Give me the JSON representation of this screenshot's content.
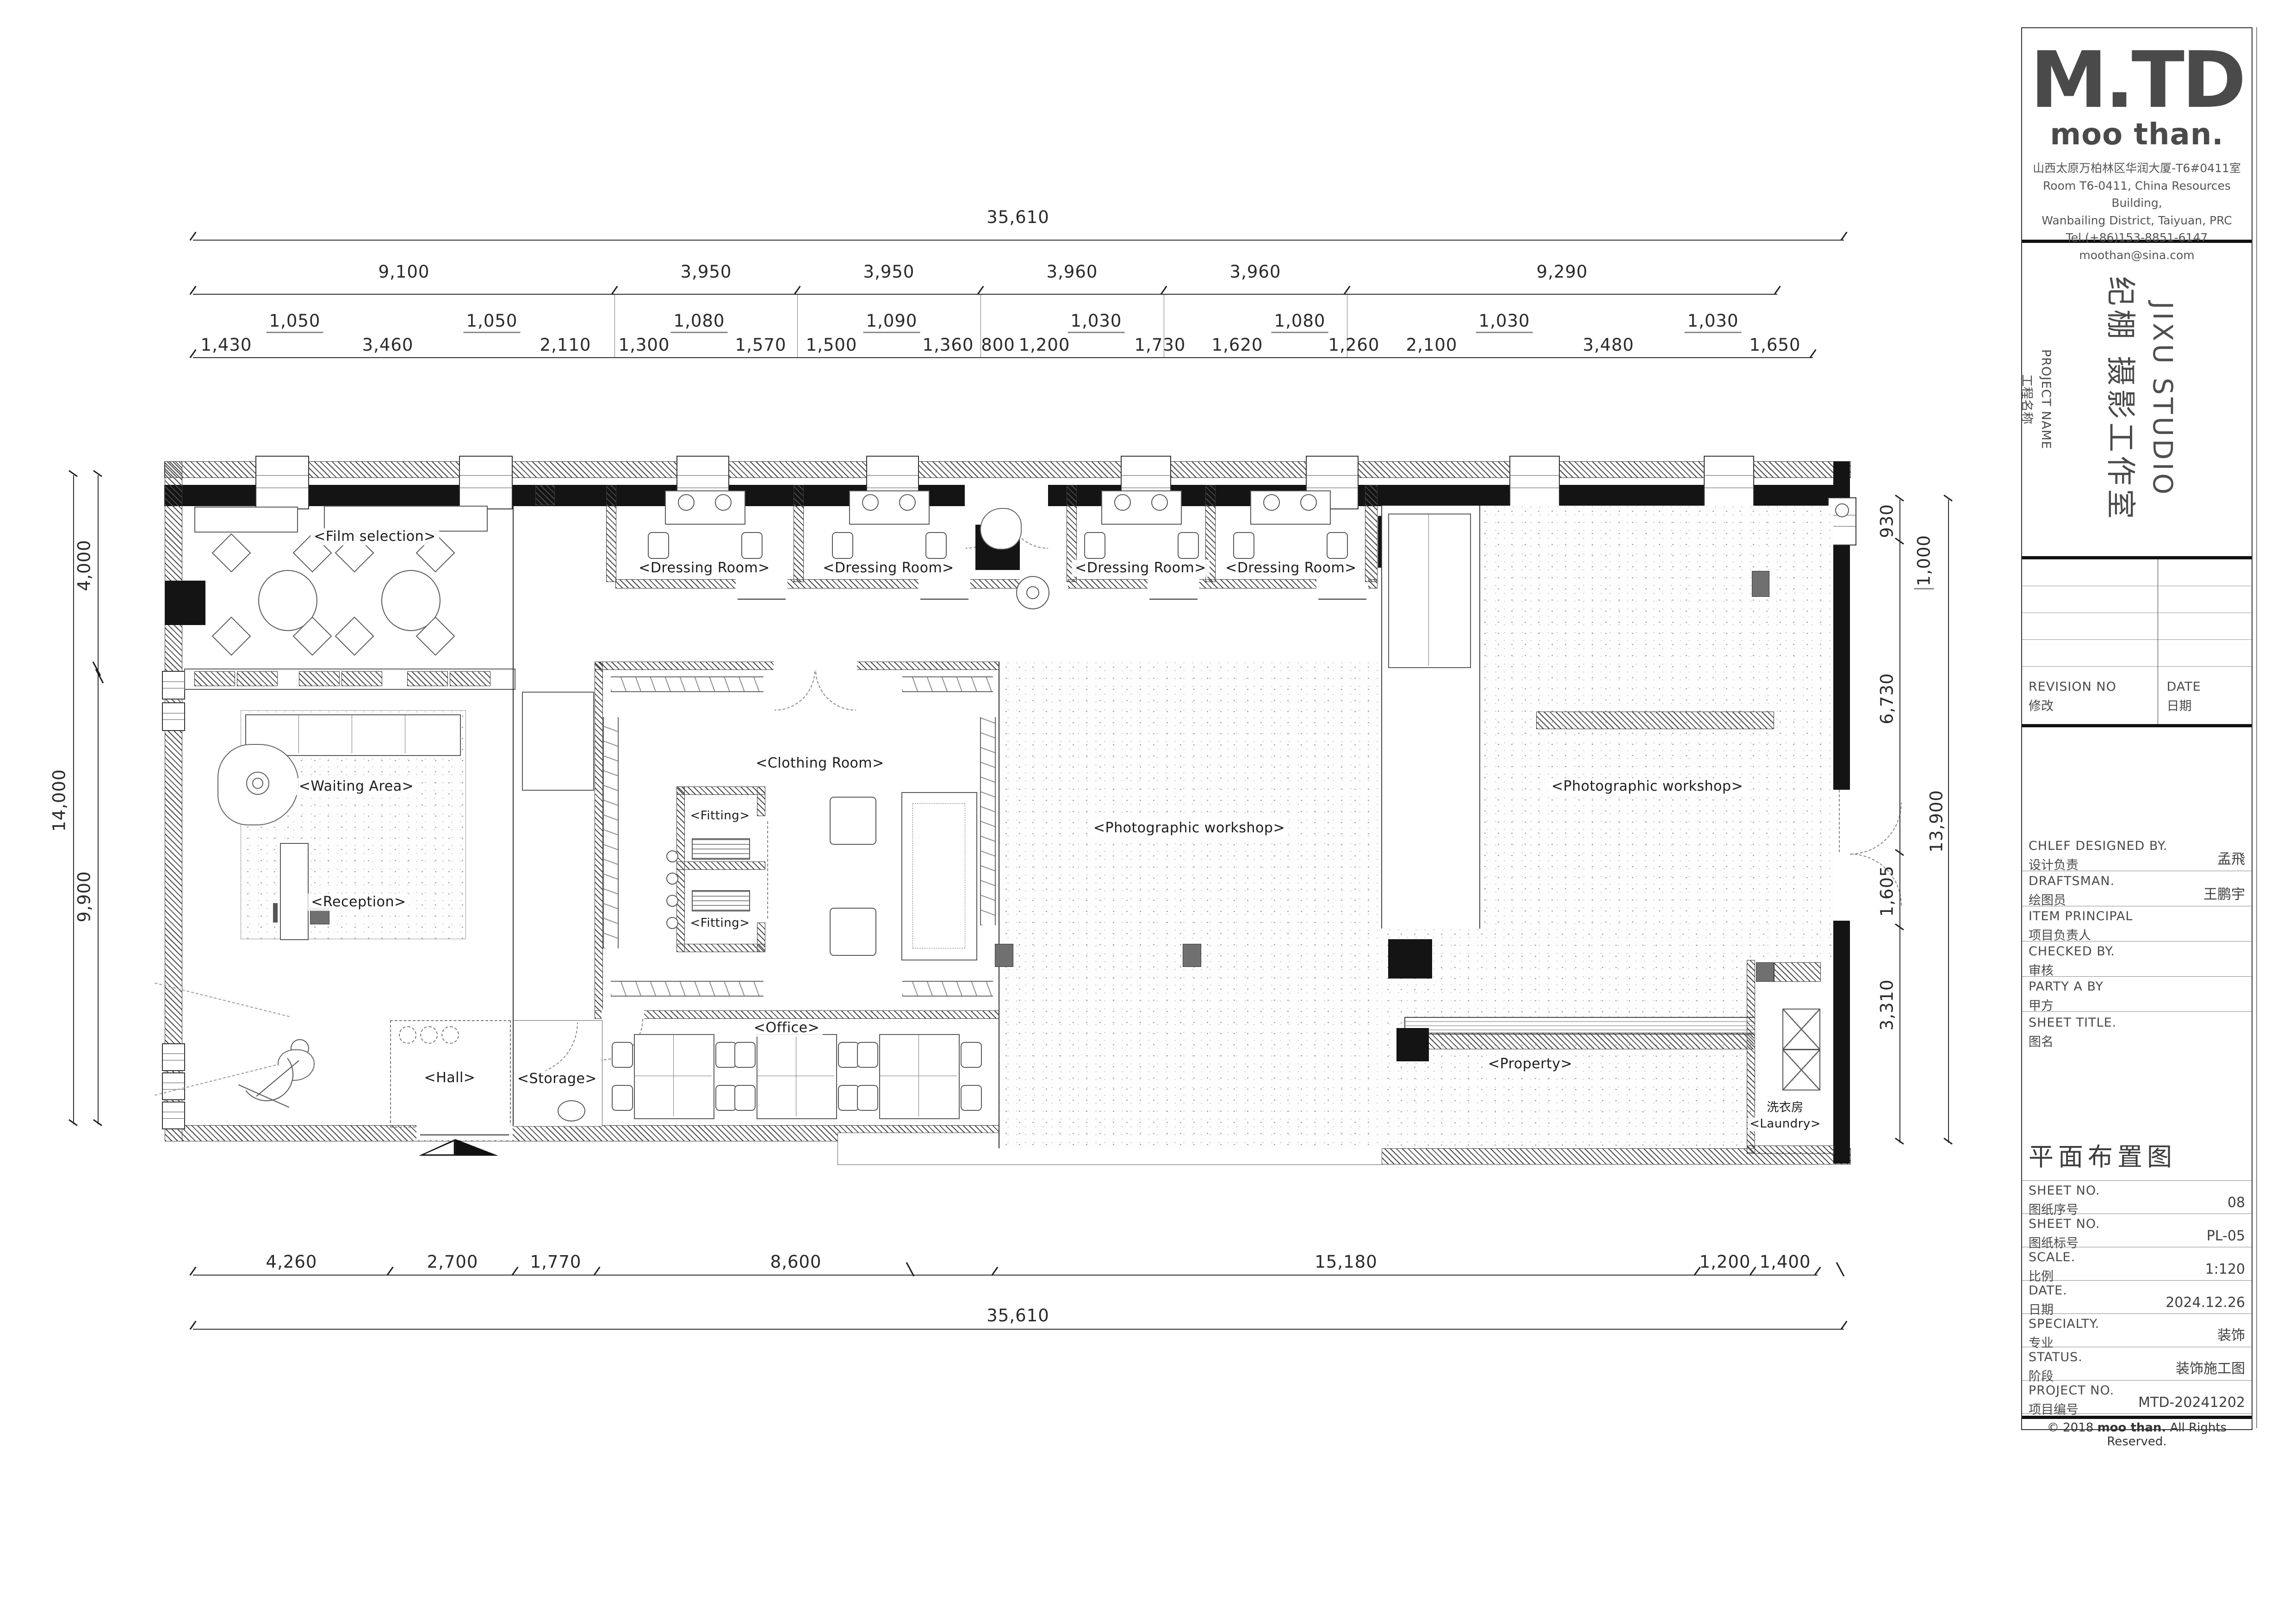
{
  "plan": {
    "rooms": {
      "film_selection": "<Film selection>",
      "dressing_room": "<Dressing Room>",
      "waiting_area": "<Waiting Area>",
      "reception": "<Reception>",
      "fitting": "<Fitting>",
      "clothing_room": "<Clothing Room>",
      "office": "<Office>",
      "hall": "<Hall>",
      "storage": "<Storage>",
      "photographic_workshop": "<Photographic workshop>",
      "property": "<Property>",
      "laundry_cn": "洗衣房",
      "laundry": "<Laundry>"
    },
    "dims": {
      "top_total": "35,610",
      "top_row2": [
        "9,100",
        "3,950",
        "3,950",
        "3,960",
        "3,960",
        "9,290"
      ],
      "top_leaders": [
        "1,050",
        "1,050",
        "1,080",
        "1,090",
        "1,030",
        "1,080",
        "1,030",
        "1,030"
      ],
      "top_row3": [
        "1,430",
        "3,460",
        "2,110",
        "1,300",
        "1,570",
        "1,500",
        "1,360",
        "800",
        "1,200",
        "1,730",
        "1,620",
        "1,260",
        "2,100",
        "3,480",
        "1,650"
      ],
      "left_total": "14,000",
      "left_segs": [
        "4,000",
        "9,900"
      ],
      "right_segs": [
        "930",
        "6,730",
        "1,605",
        "3,310"
      ],
      "right_leader": "1,000",
      "right_total": "13,900",
      "bottom_row": [
        "4,260",
        "2,700",
        "1,770",
        "8,600",
        "15,180",
        "1,200",
        "1,400"
      ],
      "bottom_total": "35,610"
    }
  },
  "title_block": {
    "logo_mtd": "M.TD",
    "logo_brand": "moo than.",
    "address": [
      "山西太原万柏林区华润大厦-T6#0411室",
      "Room T6-0411, China Resources Building,",
      "Wanbailing District, Taiyuan, PRC",
      "Tel.(+86)153-8851-6147",
      "moothan@sina.com"
    ],
    "project_label_en": "PROJECT NAME",
    "project_label_cn": "工程名称",
    "project_cn": "纪棚 摄影工作室",
    "project_en": "JIXU STUDIO",
    "revision_en": "REVISION NO",
    "revision_cn": "修改",
    "date_en": "DATE",
    "date_cn": "日期",
    "rows": [
      {
        "en": "CHLEF DESIGNED BY.",
        "cn": "设计负责",
        "value": "孟飛"
      },
      {
        "en": "DRAFTSMAN.",
        "cn": "绘图员",
        "value": "王鹏宇"
      },
      {
        "en": "ITEM PRINCIPAL",
        "cn": "项目负责人",
        "value": ""
      },
      {
        "en": "CHECKED BY.",
        "cn": "审核",
        "value": ""
      },
      {
        "en": "PARTY A BY",
        "cn": "甲方",
        "value": ""
      }
    ],
    "sheet_title_en": "SHEET TITLE.",
    "sheet_title_cn": "图名",
    "sheet_title_value": "平面布置图",
    "info_rows": [
      {
        "en": "SHEET NO.",
        "cn": "图纸序号",
        "value": "08"
      },
      {
        "en": "SHEET NO.",
        "cn": "图纸标号",
        "value": "PL-05"
      },
      {
        "en": "SCALE.",
        "cn": "比例",
        "value": "1:120"
      },
      {
        "en": "DATE.",
        "cn": "日期",
        "value": "2024.12.26"
      },
      {
        "en": "SPECIALTY.",
        "cn": "专业",
        "value": "装饰"
      },
      {
        "en": "STATUS.",
        "cn": "阶段",
        "value": "装饰施工图"
      },
      {
        "en": "PROJECT NO.",
        "cn": "项目编号",
        "value": "MTD-20241202"
      }
    ],
    "copyright_prefix": "© 2018",
    "copyright_brand": "moo than.",
    "copyright_suffix": "All Rights Reserved."
  }
}
